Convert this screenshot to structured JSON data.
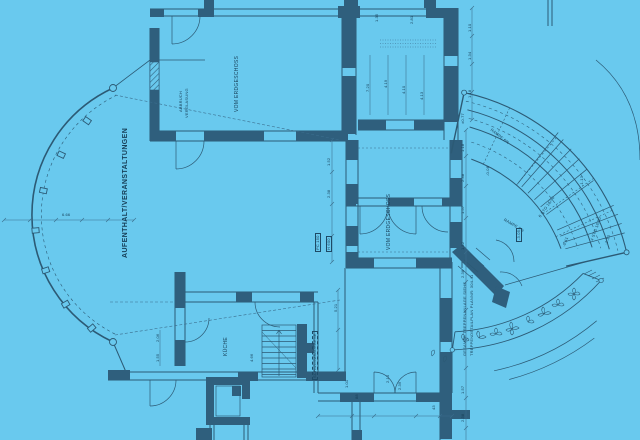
{
  "sheet": {
    "kind": "architectural floor plan blueprint"
  },
  "colors": {
    "paper": "#69c9ee",
    "wall_fill": "#2f5f7d",
    "line": "#2c5a75",
    "thin_line": "#3a6d8d",
    "text": "#173f58"
  },
  "rooms": {
    "hall": "AUFENTHALT/VERANSTALTUNGEN",
    "upper_room": "VOM ERDGESCHOSS",
    "center_room": "VOM ERDGESCHOSS",
    "kitchen": "KÜCHE",
    "demolition_note_1": "ABBRUCH",
    "demolition_note_2": "VERGLASUNG",
    "pool_level": "SCHWIMMBADEBENE"
  },
  "annotations": {
    "stair_note_1": "GESAMTE TREPPENANLAGE SIEHE",
    "stair_note_2": "TREPPENDETAILPLAN PLANNR: 304-41",
    "ramp_1": "RAMPE 6%",
    "ramp_2": "RAMPE 6%",
    "stair_steps_1": "6 STG 16/30",
    "stair_steps_2": "4 STG 16/30",
    "tag_pc": "PC 150",
    "tag_h": "H 600"
  },
  "levels": {
    "landing_box": "-3.05",
    "landing": "-0.41",
    "stair_top": "-1.13",
    "terrace_top": "±0.77",
    "terrace_mid": "-0.08",
    "terrace_low": "-1.13"
  },
  "dims": [
    "1.35",
    "2.81",
    "1.10",
    "1.34",
    "1.18",
    "7.20",
    "4.19",
    "4.10",
    "4.13",
    "1.52",
    "2.38",
    "1.18",
    "2.38",
    "1.57",
    "1.52",
    "2.38",
    "1.57",
    "2.38",
    "2.06",
    "1.55",
    "4.66",
    "1.01",
    "88",
    "2.10",
    "2.39",
    "43",
    "6.66",
    "5.21"
  ]
}
